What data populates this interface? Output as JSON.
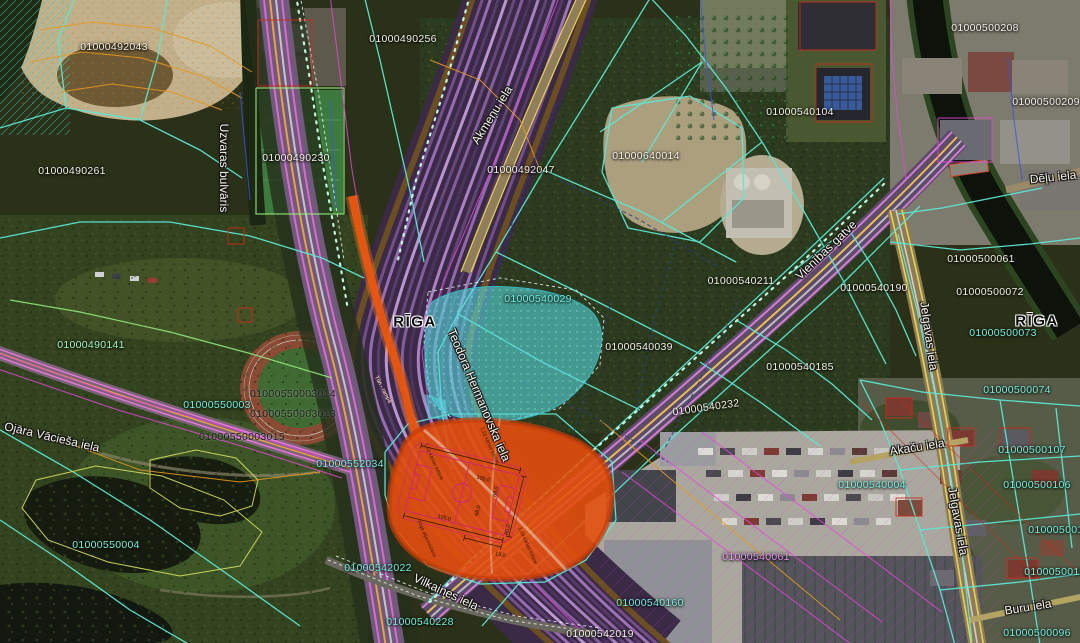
{
  "map": {
    "city_labels": [
      {
        "text": "RĪGA",
        "x": 415,
        "y": 322
      },
      {
        "text": "RĪGA",
        "x": 1037,
        "y": 321
      }
    ],
    "street_labels": [
      {
        "text": "Uzvaras bulvāris",
        "x": 224,
        "y": 168,
        "rot": 90
      },
      {
        "text": "Akmeņu iela",
        "x": 492,
        "y": 115,
        "rot": -58
      },
      {
        "text": "Teodora Hermanovska iela",
        "x": 479,
        "y": 395,
        "rot": 67
      },
      {
        "text": "Vienības gatve",
        "x": 826,
        "y": 250,
        "rot": -44
      },
      {
        "text": "Jelgavas iela",
        "x": 929,
        "y": 336,
        "rot": 82
      },
      {
        "text": "Jelgavas iela",
        "x": 958,
        "y": 521,
        "rot": 80
      },
      {
        "text": "Dēļu iela",
        "x": 1053,
        "y": 177,
        "rot": -6
      },
      {
        "text": "Akaču iela",
        "x": 917,
        "y": 447,
        "rot": -9
      },
      {
        "text": "Buru iela",
        "x": 1028,
        "y": 607,
        "rot": -9
      },
      {
        "text": "Vilkaines iela",
        "x": 446,
        "y": 592,
        "rot": 25
      },
      {
        "text": "Ojāra Vācieša iela",
        "x": 52,
        "y": 437,
        "rot": 13
      }
    ],
    "parcel_labels": [
      {
        "text": "01000492043",
        "x": 114,
        "y": 47,
        "color": "white"
      },
      {
        "text": "01000490261",
        "x": 72,
        "y": 171,
        "color": "white"
      },
      {
        "text": "01000490230",
        "x": 296,
        "y": 158,
        "color": "white"
      },
      {
        "text": "01000490256",
        "x": 403,
        "y": 39,
        "color": "white"
      },
      {
        "text": "01000492047",
        "x": 521,
        "y": 170,
        "color": "white"
      },
      {
        "text": "01000640014",
        "x": 646,
        "y": 156,
        "color": "white"
      },
      {
        "text": "01000540104",
        "x": 800,
        "y": 112,
        "color": "white"
      },
      {
        "text": "01000500208",
        "x": 985,
        "y": 28,
        "color": "white"
      },
      {
        "text": "01000500209",
        "x": 1046,
        "y": 102,
        "color": "white"
      },
      {
        "text": "01000490141",
        "x": 91,
        "y": 345,
        "color": "mint"
      },
      {
        "text": "01000540029",
        "x": 538,
        "y": 299,
        "color": "aqua"
      },
      {
        "text": "01000540039",
        "x": 639,
        "y": 347,
        "color": "white"
      },
      {
        "text": "01000540232",
        "x": 706,
        "y": 408,
        "color": "white",
        "rot": -8
      },
      {
        "text": "01000540211",
        "x": 741,
        "y": 281,
        "color": "white"
      },
      {
        "text": "01000540190",
        "x": 874,
        "y": 288,
        "color": "white"
      },
      {
        "text": "01000500061",
        "x": 981,
        "y": 259,
        "color": "white"
      },
      {
        "text": "01000500072",
        "x": 990,
        "y": 292,
        "color": "white"
      },
      {
        "text": "01000500073",
        "x": 1003,
        "y": 333,
        "color": "aqua"
      },
      {
        "text": "01000500074",
        "x": 1017,
        "y": 390,
        "color": "aqua"
      },
      {
        "text": "01000540185",
        "x": 800,
        "y": 367,
        "color": "white"
      },
      {
        "text": "01000550003",
        "x": 217,
        "y": 405,
        "color": "aqua"
      },
      {
        "text": "01000550003014",
        "x": 293,
        "y": 394,
        "color": "black"
      },
      {
        "text": "01000550003013",
        "x": 293,
        "y": 414,
        "color": "black"
      },
      {
        "text": "01000550003015",
        "x": 242,
        "y": 437,
        "color": "black"
      },
      {
        "text": "01000552034",
        "x": 350,
        "y": 464,
        "color": "aqua"
      },
      {
        "text": "01000550004",
        "x": 106,
        "y": 545,
        "color": "aqua"
      },
      {
        "text": "01000542022",
        "x": 378,
        "y": 568,
        "color": "aqua"
      },
      {
        "text": "01000540228",
        "x": 420,
        "y": 622,
        "color": "aqua"
      },
      {
        "text": "01000542019",
        "x": 600,
        "y": 634,
        "color": "white"
      },
      {
        "text": "01000540160",
        "x": 650,
        "y": 603,
        "color": "aqua"
      },
      {
        "text": "01000540061",
        "x": 756,
        "y": 557,
        "color": "plum"
      },
      {
        "text": "01000540004",
        "x": 872,
        "y": 485,
        "color": "aqua"
      },
      {
        "text": "01000500107",
        "x": 1032,
        "y": 450,
        "color": "aqua"
      },
      {
        "text": "01000500106",
        "x": 1037,
        "y": 485,
        "color": "aqua"
      },
      {
        "text": "01000500101",
        "x": 1062,
        "y": 530,
        "color": "aqua"
      },
      {
        "text": "01000500101",
        "x": 1058,
        "y": 572,
        "color": "aqua"
      },
      {
        "text": "01000500096",
        "x": 1037,
        "y": 633,
        "color": "aqua"
      }
    ],
    "stadium": {
      "dimension_labels": [
        {
          "text": "105.0",
          "x": 483,
          "y": 480,
          "rot": 14
        },
        {
          "text": "68.0",
          "x": 497,
          "y": 492,
          "rot": -76
        },
        {
          "text": "105.0",
          "x": 444,
          "y": 519,
          "rot": 14
        },
        {
          "text": "68.0",
          "x": 479,
          "y": 511,
          "rot": -76
        },
        {
          "text": "60.0",
          "x": 509,
          "y": 530,
          "rot": -76
        },
        {
          "text": "13.0",
          "x": 500,
          "y": 556,
          "rot": 14
        }
      ],
      "annotation_labels": [
        {
          "text": "1.šā kārtas tribīne",
          "x": 433,
          "y": 462,
          "rot": 66
        },
        {
          "text": "1.šā kārtas tribīne",
          "x": 489,
          "y": 446,
          "rot": 66
        },
        {
          "text": "žoga atjaunošana",
          "x": 426,
          "y": 539,
          "rot": 66
        },
        {
          "text": "1.šā kārtas tribīne",
          "x": 527,
          "y": 546,
          "rot": 66
        }
      ]
    },
    "route_label": {
      "text": "Tūn - rampa",
      "x": 382,
      "y": 390,
      "rot": 62
    }
  },
  "colors": {
    "highlight_orange": "#e8500e",
    "highlight_orange_edge": "#bf3a06",
    "highlight_cyan": "#55d8dc",
    "parcel_line_cyan": "#5ce8d4",
    "label_palette": {
      "white": "#f2efe6",
      "aqua": "#74eedd",
      "mint": "#a8f0c0",
      "black": "#1d1d1d",
      "plum": "#df97ea"
    }
  }
}
